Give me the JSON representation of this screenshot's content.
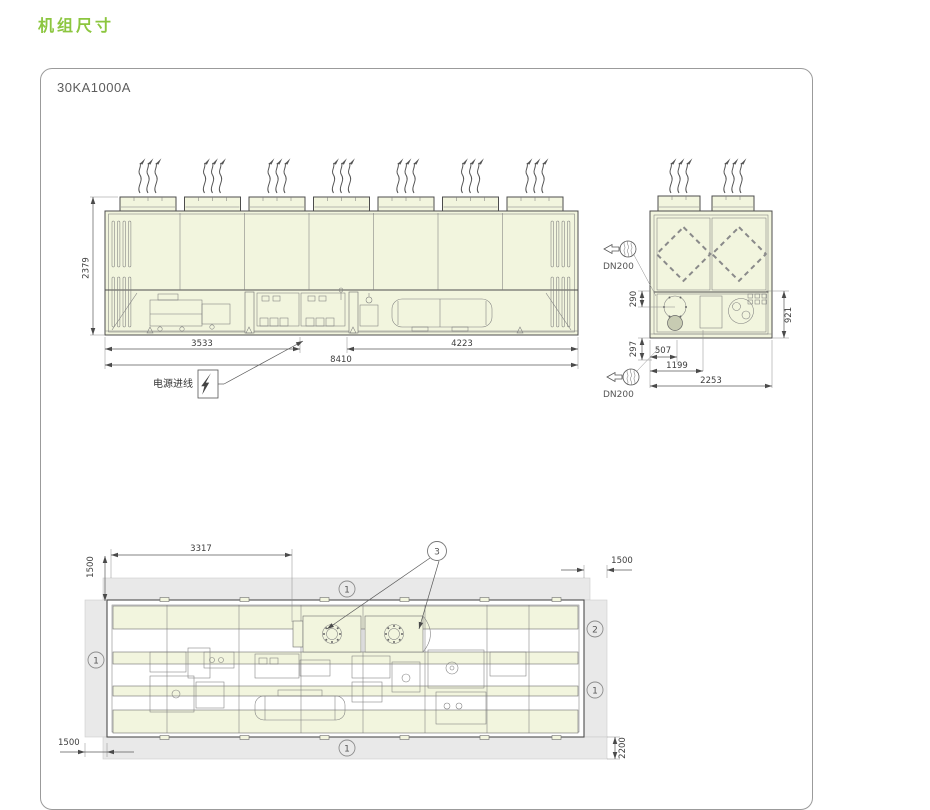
{
  "page": {
    "title": "机组尺寸"
  },
  "panel": {
    "model": "30KA1000A"
  },
  "colors": {
    "accent_green": "#8CC63F",
    "unit_fill": "#F2F5DE",
    "clearance_fill": "#E9E9E9",
    "line": "#4D4D4D"
  },
  "front_view": {
    "dims": {
      "height": "2379",
      "left_section": "3533",
      "right_section": "4223",
      "total_length": "8410"
    },
    "power_inlet_label": "电源进线"
  },
  "side_view": {
    "dims": {
      "top_offset": "290",
      "bottom_offset": "297",
      "section_height": "921",
      "pipe_offset": "507",
      "pipe_span": "1199",
      "total_width": "2253"
    },
    "top_pipe_label": "DN200",
    "bottom_pipe_label": "DN200"
  },
  "plan_view": {
    "dims": {
      "left_span": "3317",
      "clearance_top": "1500",
      "clearance_right": "1500",
      "clearance_bottom": "1500",
      "service_depth": "2200"
    },
    "callouts": {
      "top": "1",
      "left": "1",
      "right_upper": "2",
      "right_lower": "1",
      "bottom": "1",
      "connections": "3"
    }
  }
}
